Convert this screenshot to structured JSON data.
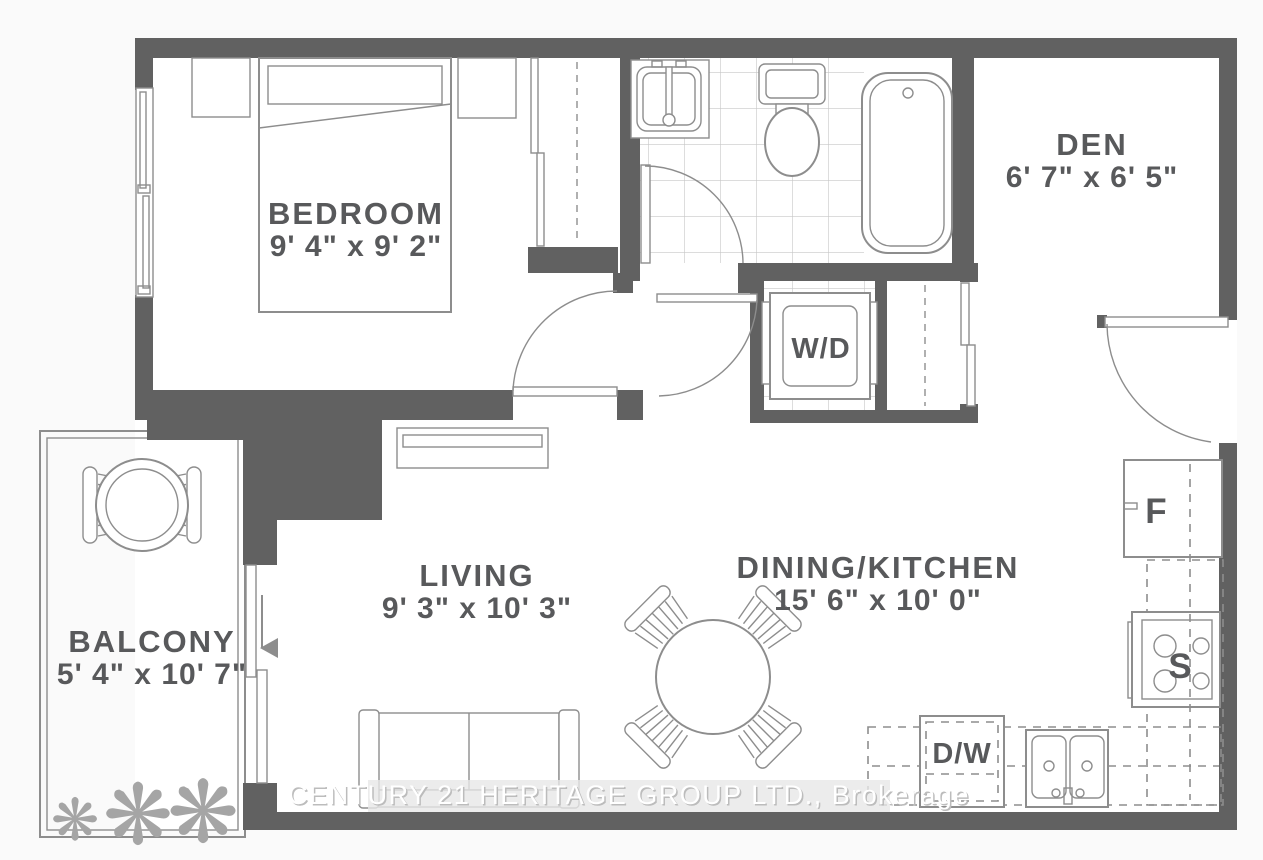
{
  "plan": {
    "rooms": {
      "bedroom": {
        "name": "BEDROOM",
        "dimensions": "9' 4\" x 9' 2\""
      },
      "den": {
        "name": "DEN",
        "dimensions": "6' 7\" x 6' 5\""
      },
      "living": {
        "name": "LIVING",
        "dimensions": "9' 3\" x 10' 3\""
      },
      "dining_kitchen": {
        "name": "DINING/KITCHEN",
        "dimensions": "15' 6\" x 10' 0\""
      },
      "balcony": {
        "name": "BALCONY",
        "dimensions": "5' 4\" x 10' 7\""
      }
    },
    "appliance_labels": {
      "washer_dryer": "W/D",
      "fridge": "F",
      "stove": "S",
      "dishwasher": "D/W"
    },
    "plant_glyph": "❋",
    "watermark": "CENTURY 21 HERITAGE GROUP LTD., Brokerage",
    "colors": {
      "wall": "#616161",
      "fixture_line": "#8d8d8d",
      "label_text": "#58595b",
      "background": "#fafafa",
      "tile_line": "#c6c6c6",
      "watermark_text": "#ffffff"
    }
  }
}
